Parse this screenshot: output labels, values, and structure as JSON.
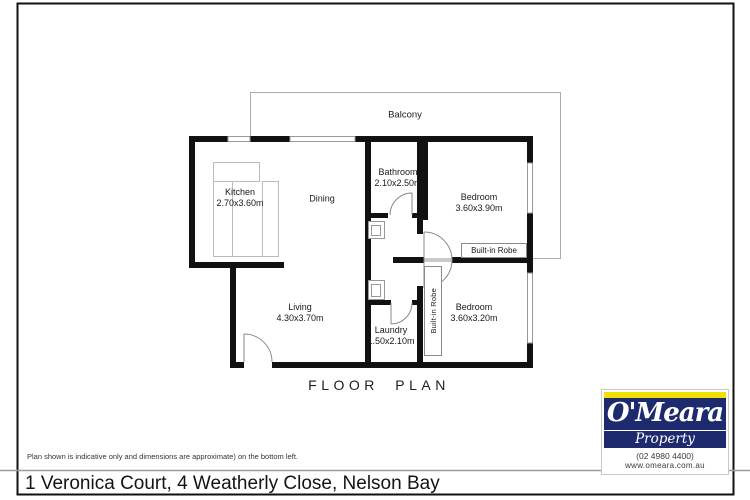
{
  "document": {
    "address": "1 Veronica Court, 4 Weatherly Close, Nelson Bay",
    "disclaimer": "Plan shown is indicative only and dimensions are approximate) on the bottom left.",
    "plan_title": "FLOOR PLAN"
  },
  "floorplan": {
    "balcony": "Balcony",
    "rooms": [
      {
        "name": "Kitchen",
        "dims": "2.70x3.60m"
      },
      {
        "name": "Dining",
        "dims": ""
      },
      {
        "name": "Bathroom",
        "dims": "2.10x2.50m"
      },
      {
        "name": "Bedroom",
        "dims": "3.60x3.90m"
      },
      {
        "name": "Living",
        "dims": "4.30x3.70m"
      },
      {
        "name": "Laundry",
        "dims": "1.50x2.10m"
      },
      {
        "name": "Bedroom",
        "dims": "3.60x3.20m"
      }
    ],
    "robe1": "Built-in Robe",
    "robe2": "Built-in Robe"
  },
  "branding": {
    "name": "O'Meara",
    "division": "Property",
    "phone": "(02 4980 4400)",
    "website": "www.omeara.com.au",
    "colors": {
      "navy": "#1d2a6d",
      "yellow": "#f0df00"
    }
  }
}
